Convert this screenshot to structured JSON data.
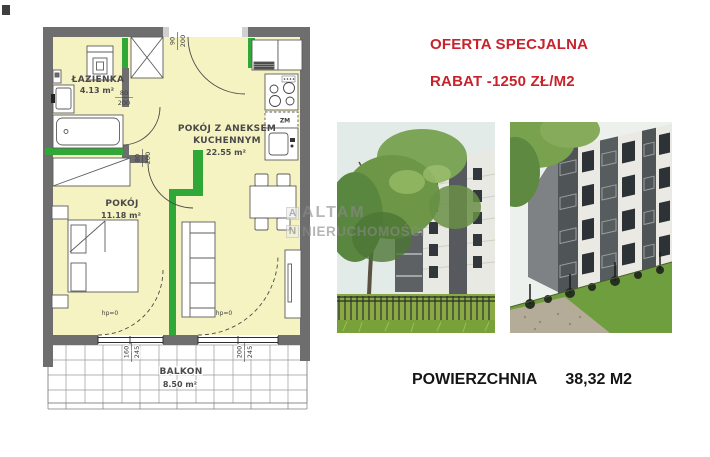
{
  "offer": {
    "line1": "OFERTA SPECJALNA",
    "line2": "RABAT -1250 ZŁ/M2",
    "color": "#c8232c"
  },
  "area_info": {
    "label": "POWIERZCHNIA",
    "value": "38,32 M2"
  },
  "watermark": {
    "logo_letter_1": "A",
    "logo_letter_2": "N",
    "word_1": "ALTAM",
    "word_2": "NIERUCHOMOŚCI"
  },
  "floorplan": {
    "colors": {
      "wall": "#6e6e6e",
      "room_fill": "#f6f3c2",
      "accent_green": "#2fa838"
    },
    "rooms": {
      "bathroom": {
        "name": "ŁAZIENKA",
        "area": "4.13 m²"
      },
      "living": {
        "line1": "POKÓJ Z ANEKSEM",
        "line2": "KUCHENNYM",
        "area": "22.55 m²"
      },
      "bedroom": {
        "name": "POKÓJ",
        "area": "11.18 m²"
      },
      "balcony": {
        "name": "BALKON",
        "area": "8.50 m²"
      }
    },
    "dims": {
      "entrance_w": "90",
      "entrance_h": "200",
      "bath_w": "80",
      "bath_h": "200",
      "bed_w": "80",
      "bed_h": "200",
      "balc_left_w": "160",
      "balc_left_h": "245",
      "balc_right_w": "200",
      "balc_right_h": "245"
    },
    "annotations": {
      "hp_left": "hp=0",
      "hp_right": "hp=0",
      "zm": "ZM"
    }
  }
}
